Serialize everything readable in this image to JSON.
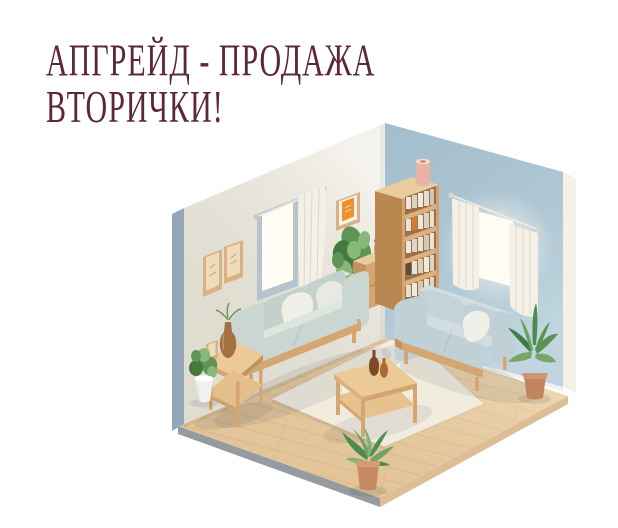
{
  "title": {
    "line1": "АПГРЕЙД - ПРОДАЖА",
    "line2": "ВТОРИЧКИ!"
  },
  "colors": {
    "page_bg": "#ffffff",
    "title_text": "#5d2733",
    "wall_left": "#efece2",
    "wall_left_edge": "#93a8bb",
    "wall_right": "#aec9d6",
    "wall_right_edge": "#f4f1e8",
    "floor_wood": "#ecd0a6",
    "floor_seam": "#d3a878",
    "floor_edge_gray": "#949ba1",
    "floor_edge_wood": "#ddbe94",
    "rug": "#f2ecdf",
    "window_glow": "#fffdf3",
    "window_frame": "#b5c4cf",
    "curtain": "#f4f0e6",
    "sofa_fabric": "#c9d6d1",
    "sofa_fabric_light": "#dde5df",
    "sofa2_fabric": "#c0d0d7",
    "sofa2_fabric_light": "#d2dde1",
    "pillow_white": "#f0f0e8",
    "wood_light": "#ecca96",
    "wood_mid": "#d5a671",
    "wood_dark": "#c2935c",
    "bookshelf_front": "#d3a471",
    "bookshelf_side": "#bb8751",
    "bookshelf_top": "#e9cd9f",
    "basket": "#b79a66",
    "plant_green": "#5f9456",
    "plant_green_dark": "#46793f",
    "plant_green_light": "#86b87a",
    "terracotta": "#c0845f",
    "terracotta_light": "#cf9570",
    "pot_white": "#f0f1ec",
    "vase_brown": "#a5703f",
    "bottle_amber": "#a96a33",
    "bottle_dark": "#7d4a26",
    "vase_pink": "#e9b2a3",
    "art_orange": "#ef8f2e",
    "frame_wood": "#d9b184",
    "frame_art": "#eddbb9"
  }
}
